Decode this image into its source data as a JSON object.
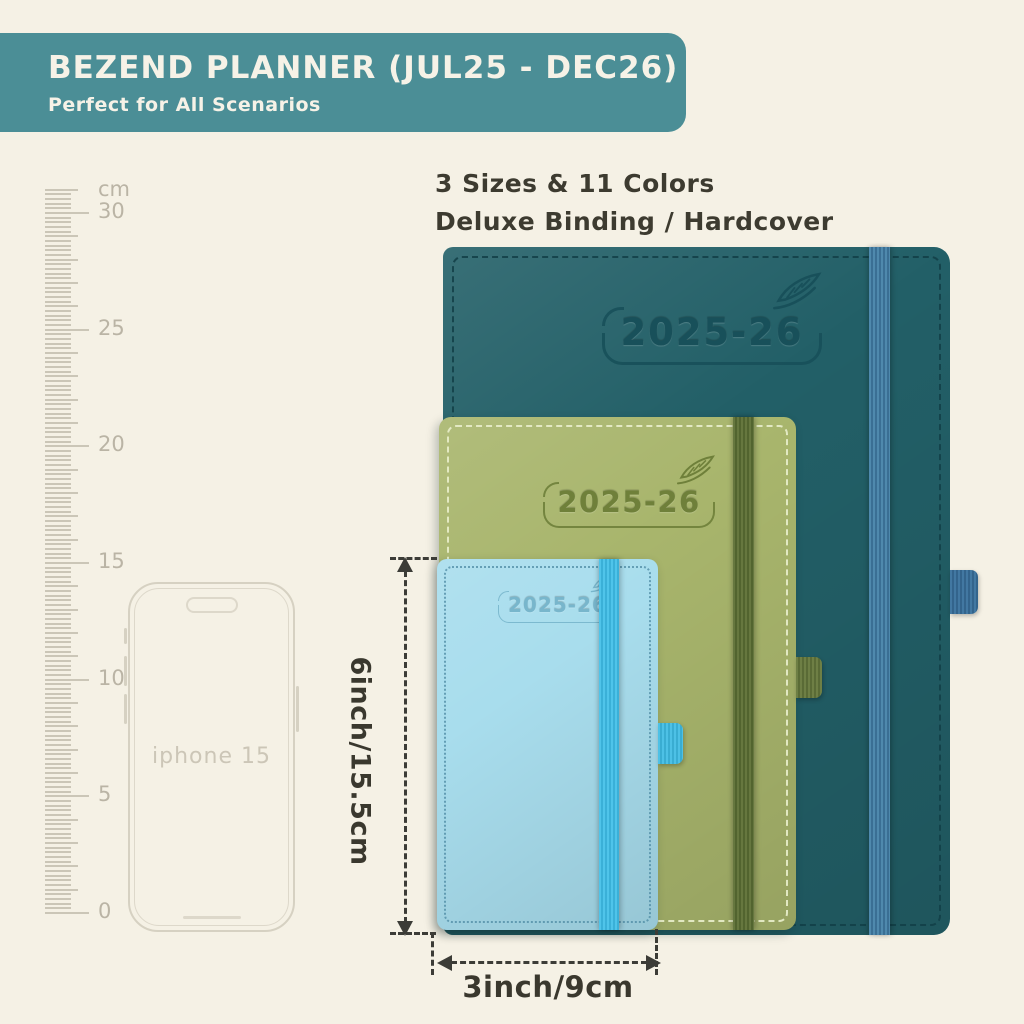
{
  "banner": {
    "title": "BEZEND PLANNER (JUL25 - DEC26)",
    "subtitle": "Perfect for All Scenarios"
  },
  "info": {
    "line1": "3 Sizes & 11 Colors",
    "line2": "Deluxe Binding / Hardcover"
  },
  "ruler": {
    "unit": "cm",
    "labeled_cm": [
      0,
      5,
      10,
      15,
      20,
      25,
      30
    ],
    "max_cm": 31
  },
  "phone": {
    "label": "iphone 15"
  },
  "planners": [
    {
      "name": "large",
      "year": "2025-26",
      "cover": "#225f67",
      "emboss": "#18505a",
      "band": [
        "#4f89ad",
        "#3a6f94"
      ],
      "loop": [
        "#4278a2",
        "#33648c"
      ],
      "stitch": "#123f47"
    },
    {
      "name": "medium",
      "year": "2025-26",
      "cover": "#a8b56c",
      "emboss": "#6f803a",
      "band": [
        "#66773f",
        "#52642f"
      ],
      "loop": [
        "#6e7f45",
        "#5a6b36"
      ],
      "stitch": "#e6ecc8"
    },
    {
      "name": "small",
      "year": "2025-26",
      "cover": "#a8dded",
      "emboss": "#78b6cc",
      "band": [
        "#4fc4ea",
        "#3ab0d8"
      ],
      "loop": [
        "#4dc1e6",
        "#39add2"
      ],
      "stitch": "#4d8aa3"
    }
  ],
  "dimensions": {
    "height_label": "6inch/15.5cm",
    "width_label": "3inch/9cm"
  },
  "colors": {
    "background": "#f5f1e5",
    "banner_bg": "#4b8e96",
    "banner_text": "#f6f2e7",
    "info_text": "#3d3b30",
    "ruler": "#cbc6b7",
    "ruler_label": "#bab4a5",
    "phone_outline": "#d6d1c2",
    "phone_inner": "#ddd8ca",
    "phone_label": "#ccc6b7",
    "dim": "#3c3c37",
    "dim_text": "#3a382e"
  }
}
